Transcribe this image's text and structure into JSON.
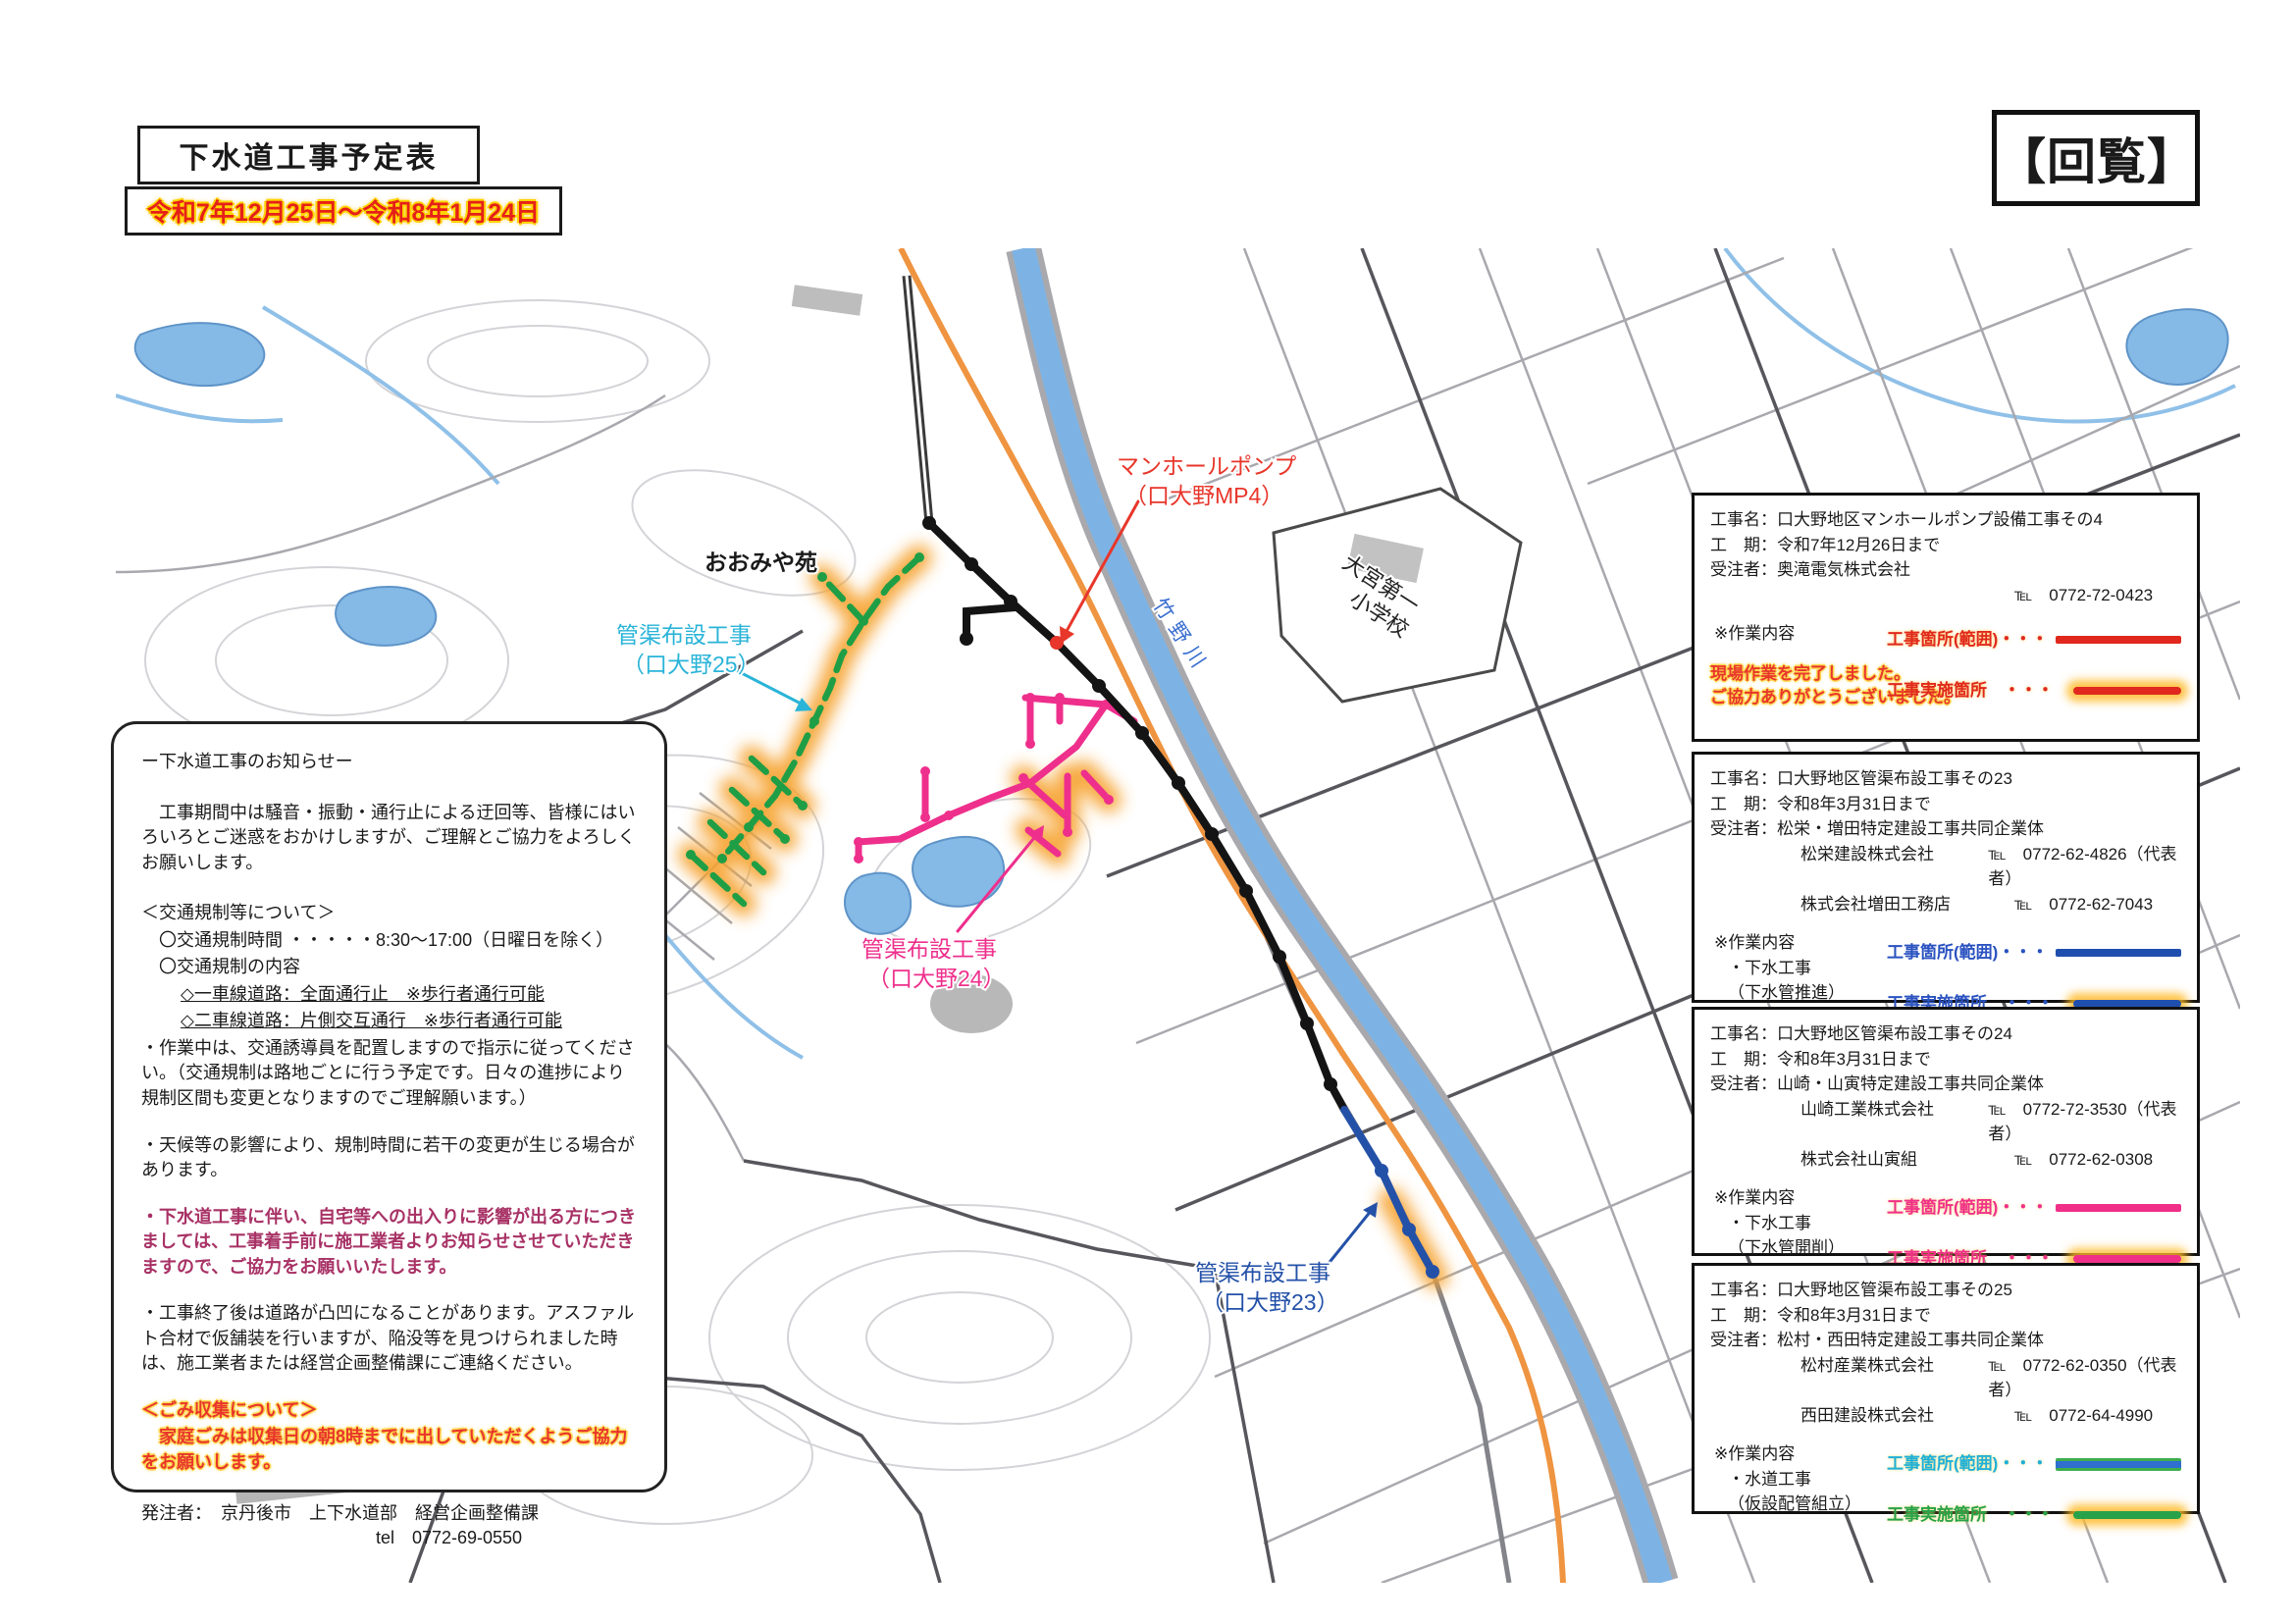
{
  "header": {
    "title": "下水道工事予定表",
    "date_range": "令和7年12月25日～令和8年1月24日",
    "circulation_badge": "【回覧】"
  },
  "notice": {
    "heading": "ー下水道工事のお知らせー",
    "intro": "　工事期間中は騒音・振動・通行止による迂回等、皆様にはいろいろとご迷惑をおかけしますが、ご理解とご協力をよろしくお願いします。",
    "traffic_title": "＜交通規制等について＞",
    "traffic_time": "〇交通規制時間 ・・・・・8:30～17:00（日曜日を除く）",
    "traffic_detail": "〇交通規制の内容",
    "lane_single": "◇一車線道路：全面通行止　※歩行者通行可能",
    "lane_double": "◇二車線道路：片側交互通行　※歩行者通行可能",
    "note_guard": "・作業中は、交通誘導員を配置しますので指示に従ってください。（交通規制は路地ごとに行う予定です。日々の進捗により規制区間も変更となりますのでご理解願います。）",
    "note_weather": "・天候等の影響により、規制時間に若干の変更が生じる場合があります。",
    "note_access": "・下水道工事に伴い、自宅等への出入りに影響が出る方につきましては、工事着手前に施工業者よりお知らせさせていただきますので、ご協力をお願いいたします。",
    "note_pavement": "・工事終了後は道路が凸凹になることがあります。アスファルト合材で仮舗装を行いますが、陥没等を見つけられました時は、施工業者または経営企画整備課にご連絡ください。",
    "garbage_title": "＜ごみ収集について＞",
    "garbage_body": "　家庭ごみは収集日の朝8時までに出していただくようご協力をお願いします。",
    "orderer": "発注者：　京丹後市　上下水道部　経営企画整備課",
    "orderer_tel": "tel　0772-69-0550"
  },
  "projects": [
    {
      "name": "工事名：口大野地区マンホールポンプ設備工事その4",
      "period": "工　期：令和7年12月26日まで",
      "orderer": "受注者：奥滝電気株式会社",
      "companies": [
        {
          "company": "",
          "tel": "℡　0772-72-0423"
        }
      ],
      "work_title": "※作業内容",
      "completion_note_1": "現場作業を完了しました。",
      "completion_note_2": "ご協力ありがとうございました。",
      "legend_range_label": "工事箇所(範囲)・・・",
      "legend_done_label": "工事実施箇所　・・・",
      "legend_color": "#e0281e",
      "highlight_color": "#ffba28"
    },
    {
      "name": "工事名：口大野地区管渠布設工事その23",
      "period": "工　期：令和8年3月31日まで",
      "orderer": "受注者：松栄・増田特定建設工事共同企業体",
      "companies": [
        {
          "company": "松栄建設株式会社",
          "tel": "℡　0772-62-4826（代表者）"
        },
        {
          "company": "株式会社増田工務店",
          "tel": "℡　0772-62-7043"
        }
      ],
      "work_title": "※作業内容",
      "work_line_1": "・下水工事",
      "work_line_2": "（下水管推進）",
      "legend_range_label": "工事箇所(範囲)・・・",
      "legend_done_label": "工事実施箇所　・・・",
      "legend_color": "#1f4fae",
      "highlight_color": "#ffba28"
    },
    {
      "name": "工事名：口大野地区管渠布設工事その24",
      "period": "工　期：令和8年3月31日まで",
      "orderer": "受注者：山崎・山寅特定建設工事共同企業体",
      "companies": [
        {
          "company": "山崎工業株式会社",
          "tel": "℡　0772-72-3530（代表者）"
        },
        {
          "company": "株式会社山寅組",
          "tel": "℡　0772-62-0308"
        }
      ],
      "work_title": "※作業内容",
      "work_line_1": "・下水工事",
      "work_line_2": "（下水管開削）",
      "legend_range_label": "工事箇所(範囲)・・・",
      "legend_done_label": "工事実施箇所　・・・",
      "legend_color": "#f03088",
      "highlight_color": "#ffba28"
    },
    {
      "name": "工事名：口大野地区管渠布設工事その25",
      "period": "工　期：令和8年3月31日まで",
      "orderer": "受注者：松村・西田特定建設工事共同企業体",
      "companies": [
        {
          "company": "松村産業株式会社",
          "tel": "℡　0772-62-0350（代表者）"
        },
        {
          "company": "西田建設株式会社",
          "tel": "℡　0772-64-4990"
        }
      ],
      "work_title": "※作業内容",
      "work_line_1": "・水道工事",
      "work_line_2": "（仮設配管組立）",
      "legend_range_label": "工事箇所(範囲)・・・",
      "legend_done_label": "工事実施箇所　・・・",
      "legend_color": "#27a24a",
      "highlight_color": "#ffba28"
    }
  ],
  "map": {
    "facility_label": "おおみや苑",
    "river_label": "竹野川",
    "school_label_1": "大宮第一",
    "school_label_2": "小学校",
    "route25_label_1": "管渠布設工事",
    "route25_label_2": "（口大野25）",
    "mp4_label_1": "マンホールポンプ",
    "mp4_label_2": "（口大野MP4）",
    "route24_label_1": "管渠布設工事",
    "route24_label_2": "（口大野24）",
    "route23_label_1": "管渠布設工事",
    "route23_label_2": "（口大野23）",
    "colors": {
      "route23_blue": "#2451a8",
      "route24_pink": "#ee2f8c",
      "route25_green": "#1f9e46",
      "mp4_red": "#e8362b",
      "highlight_orange": "#f6a22e",
      "main_road_orange": "#ef9440",
      "river_blue": "#7db3e4"
    }
  }
}
